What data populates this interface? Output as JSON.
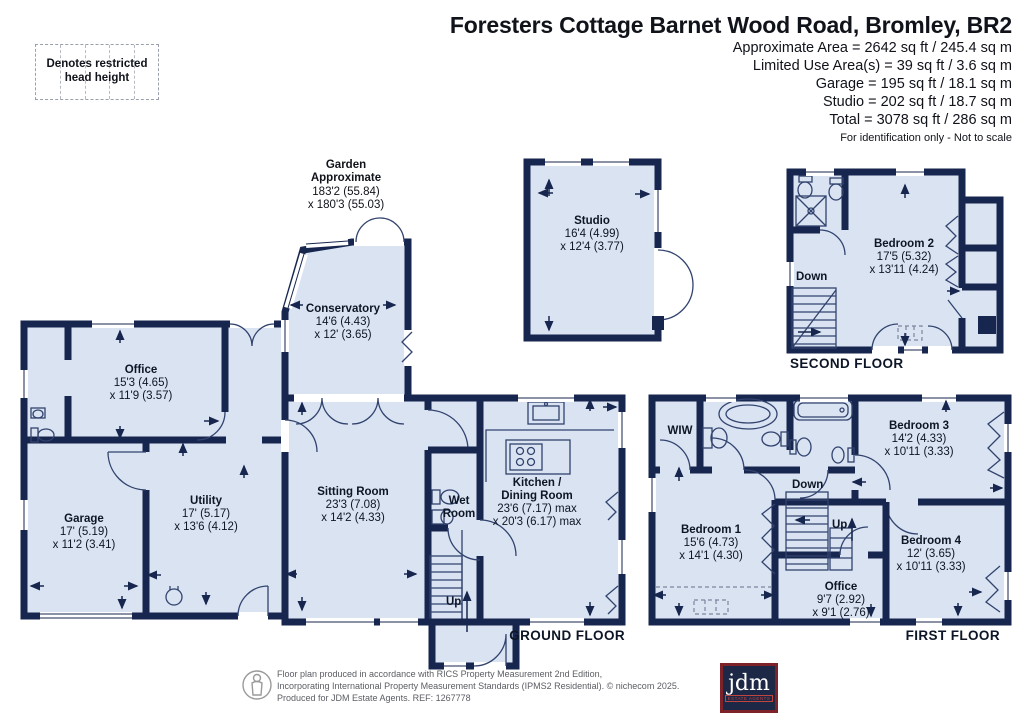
{
  "header": {
    "title": "Foresters Cottage Barnet Wood Road, Bromley, BR2",
    "area_lines": [
      "Approximate Area = 2642 sq ft / 245.4 sq m",
      "Limited Use Area(s) = 39 sq ft / 3.6 sq m",
      "Garage = 195 sq ft / 18.1 sq m",
      "Studio = 202 sq ft / 18.7 sq m",
      "Total = 3078 sq ft / 286 sq m"
    ],
    "note": "For identification only - Not to scale"
  },
  "legend": {
    "text": "Denotes restricted\nhead height"
  },
  "garden": {
    "name": "Garden\nApproximate",
    "dims": "183'2 (55.84)\nx 180'3 (55.03)"
  },
  "rooms": {
    "studio": {
      "name": "Studio",
      "dims": "16'4 (4.99)\nx 12'4 (3.77)"
    },
    "conservatory": {
      "name": "Conservatory",
      "dims": "14'6 (4.43)\nx 12' (3.65)"
    },
    "office_gf": {
      "name": "Office",
      "dims": "15'3 (4.65)\nx 11'9 (3.57)"
    },
    "garage": {
      "name": "Garage",
      "dims": "17' (5.19)\nx 11'2 (3.41)"
    },
    "utility": {
      "name": "Utility",
      "dims": "17' (5.17)\nx 13'6 (4.12)"
    },
    "sitting": {
      "name": "Sitting Room",
      "dims": "23'3 (7.08)\nx 14'2 (4.33)"
    },
    "wet": {
      "name": "Wet\nRoom",
      "dims": ""
    },
    "kitchen": {
      "name": "Kitchen /\nDining Room",
      "dims": "23'6 (7.17) max\nx 20'3 (6.17) max"
    },
    "bedroom1": {
      "name": "Bedroom 1",
      "dims": "15'6 (4.73)\nx 14'1 (4.30)"
    },
    "bedroom2": {
      "name": "Bedroom 2",
      "dims": "17'5 (5.32)\nx 13'11 (4.24)"
    },
    "bedroom3": {
      "name": "Bedroom 3",
      "dims": "14'2 (4.33)\nx 10'11 (3.33)"
    },
    "bedroom4": {
      "name": "Bedroom 4",
      "dims": "12' (3.65)\nx 10'11 (3.33)"
    },
    "office_ff": {
      "name": "Office",
      "dims": "9'7 (2.92)\nx 9'1 (2.76)"
    },
    "wiw": {
      "name": "WIW",
      "dims": ""
    }
  },
  "floors": {
    "ground": "GROUND FLOOR",
    "first": "FIRST FLOOR",
    "second": "SECOND FLOOR"
  },
  "nav": {
    "up_ground": "Up",
    "down_first": "Down",
    "up_first": "Up",
    "down_second": "Down"
  },
  "footer": {
    "line1": "Floor plan produced in accordance with RICS Property Measurement 2nd Edition,",
    "line2": "Incorporating International Property Measurement Standards (IPMS2 Residential).   © nichecom 2025.",
    "line3": "Produced for JDM Estate Agents.   REF: 1267778",
    "logo_text": "jdm",
    "logo_sub": "ESTATE AGENTS"
  },
  "colors": {
    "wall": "#17264e",
    "room_fill": "#d9e3f2",
    "logo_navy": "#1d2746",
    "logo_red": "#7d2229"
  }
}
